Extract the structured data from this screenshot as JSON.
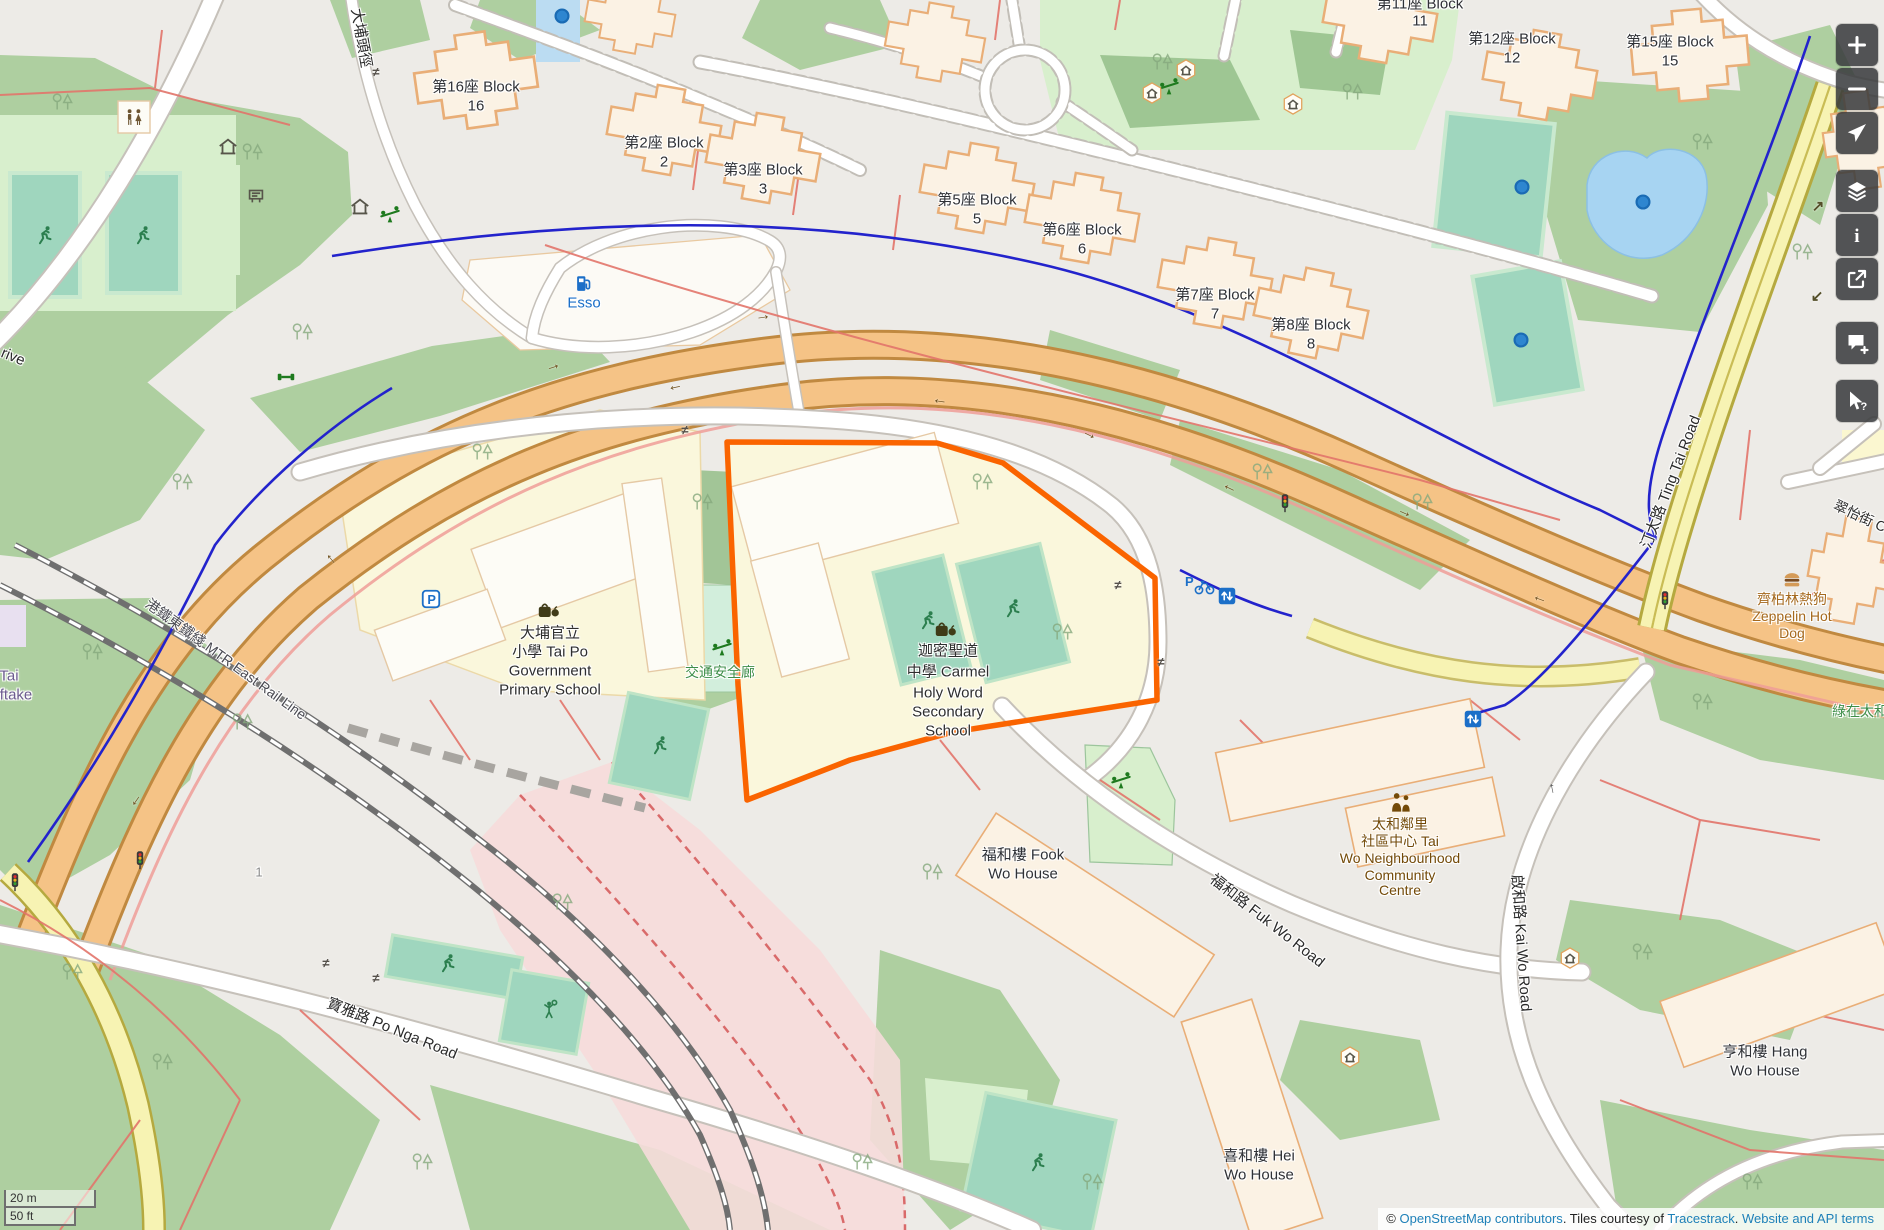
{
  "colors": {
    "highlight": "#FA6400",
    "link_blue": "#1E80B8",
    "trunk_road": "#F5C386",
    "secondary_road": "#F7F3B3",
    "water": "#A7D4F2",
    "pitch": "#9FD6BE",
    "wood": "#AECFA0",
    "building": "#FBF2E4",
    "control_bg": "rgba(56,58,60,0.86)"
  },
  "scalebar": {
    "metric": "20 m",
    "imperial": "50 ft"
  },
  "attribution": {
    "prefix": "© ",
    "link_osm": "OpenStreetMap contributors",
    "mid": ". Tiles courtesy of ",
    "link_tiles": "Tracestrack",
    "sep": ". ",
    "link_terms": "Website and API terms"
  },
  "controls": [
    {
      "name": "zoom-in-button",
      "icon": "plus",
      "y": 24
    },
    {
      "name": "zoom-out-button",
      "icon": "minus",
      "y": 68
    },
    {
      "name": "show-location-button",
      "icon": "locate",
      "y": 112
    },
    {
      "name": "layers-button",
      "icon": "layers",
      "y": 170
    },
    {
      "name": "map-key-button",
      "icon": "info",
      "y": 214
    },
    {
      "name": "share-button",
      "icon": "share",
      "y": 258
    },
    {
      "name": "add-note-button",
      "icon": "note",
      "y": 322
    },
    {
      "name": "query-features-button",
      "icon": "query",
      "y": 380
    }
  ],
  "map": {
    "highlighted_feature": "迦密聖道中學 Carmel Holy Word Secondary School",
    "labels": [
      {
        "name": "label-block-16-l1",
        "text": "第16座 Block",
        "x": 476,
        "y": 87,
        "color": "#2F3136",
        "size": 15
      },
      {
        "name": "label-block-16-l2",
        "text": "16",
        "x": 476,
        "y": 106,
        "color": "#2F3136",
        "size": 15
      },
      {
        "name": "label-block-2-l1",
        "text": "第2座 Block",
        "x": 664,
        "y": 143,
        "color": "#2F3136",
        "size": 15
      },
      {
        "name": "label-block-2-l2",
        "text": "2",
        "x": 664,
        "y": 162,
        "color": "#2F3136",
        "size": 15
      },
      {
        "name": "label-block-3-l1",
        "text": "第3座 Block",
        "x": 763,
        "y": 170,
        "color": "#2F3136",
        "size": 15
      },
      {
        "name": "label-block-3-l2",
        "text": "3",
        "x": 763,
        "y": 189,
        "color": "#2F3136",
        "size": 15
      },
      {
        "name": "label-block-5-l1",
        "text": "第5座 Block",
        "x": 977,
        "y": 200,
        "color": "#2F3136",
        "size": 15
      },
      {
        "name": "label-block-5-l2",
        "text": "5",
        "x": 977,
        "y": 219,
        "color": "#2F3136",
        "size": 15
      },
      {
        "name": "label-block-6-l1",
        "text": "第6座 Block",
        "x": 1082,
        "y": 230,
        "color": "#2F3136",
        "size": 15
      },
      {
        "name": "label-block-6-l2",
        "text": "6",
        "x": 1082,
        "y": 249,
        "color": "#2F3136",
        "size": 15
      },
      {
        "name": "label-block-7-l1",
        "text": "第7座 Block",
        "x": 1215,
        "y": 295,
        "color": "#2F3136",
        "size": 15
      },
      {
        "name": "label-block-7-l2",
        "text": "7",
        "x": 1215,
        "y": 314,
        "color": "#2F3136",
        "size": 15
      },
      {
        "name": "label-block-8-l1",
        "text": "第8座 Block",
        "x": 1311,
        "y": 325,
        "color": "#2F3136",
        "size": 15
      },
      {
        "name": "label-block-8-l2",
        "text": "8",
        "x": 1311,
        "y": 344,
        "color": "#2F3136",
        "size": 15
      },
      {
        "name": "label-block-11-l1",
        "text": "第11座 Block",
        "x": 1420,
        "y": 4,
        "color": "#2F3136",
        "size": 15
      },
      {
        "name": "label-block-11-l2",
        "text": "11",
        "x": 1420,
        "y": 21,
        "color": "#2F3136",
        "size": 15
      },
      {
        "name": "label-block-12-l1",
        "text": "第12座 Block",
        "x": 1512,
        "y": 39,
        "color": "#2F3136",
        "size": 15
      },
      {
        "name": "label-block-12-l2",
        "text": "12",
        "x": 1512,
        "y": 58,
        "color": "#2F3136",
        "size": 15
      },
      {
        "name": "label-block-15-l1",
        "text": "第15座 Block",
        "x": 1670,
        "y": 42,
        "color": "#2F3136",
        "size": 15
      },
      {
        "name": "label-block-15-l2",
        "text": "15",
        "x": 1670,
        "y": 61,
        "color": "#2F3136",
        "size": 15
      },
      {
        "name": "label-primary-school-l1",
        "text": "大埔官立",
        "x": 550,
        "y": 633,
        "color": "#2E2E2E",
        "size": 15
      },
      {
        "name": "label-primary-school-l2",
        "text": "小學 Tai Po",
        "x": 550,
        "y": 652,
        "color": "#2E2E2E",
        "size": 15
      },
      {
        "name": "label-primary-school-l3",
        "text": "Government",
        "x": 550,
        "y": 671,
        "color": "#2E2E2E",
        "size": 15
      },
      {
        "name": "label-primary-school-l4",
        "text": "Primary School",
        "x": 550,
        "y": 690,
        "color": "#2E2E2E",
        "size": 15
      },
      {
        "name": "label-carmel-school-l1",
        "text": "迦密聖道",
        "x": 948,
        "y": 651,
        "color": "#2E2E2E",
        "size": 15
      },
      {
        "name": "label-carmel-school-l2",
        "text": "中學 Carmel",
        "x": 948,
        "y": 672,
        "color": "#2E2E2E",
        "size": 15
      },
      {
        "name": "label-carmel-school-l3",
        "text": "Holy Word",
        "x": 948,
        "y": 693,
        "color": "#2E2E2E",
        "size": 15
      },
      {
        "name": "label-carmel-school-l4",
        "text": "Secondary",
        "x": 948,
        "y": 712,
        "color": "#2E2E2E",
        "size": 15
      },
      {
        "name": "label-carmel-school-l5",
        "text": "School",
        "x": 948,
        "y": 731,
        "color": "#2E2E2E",
        "size": 15
      },
      {
        "name": "label-traffic-safety-gallery",
        "text": "交通安全廊",
        "x": 720,
        "y": 672,
        "color": "#3E8E49",
        "size": 14
      },
      {
        "name": "label-esso",
        "text": "Esso",
        "x": 584,
        "y": 303,
        "color": "#1C6FC8",
        "size": 15
      },
      {
        "name": "label-fook-wo-house-l1",
        "text": "福和樓 Fook",
        "x": 1023,
        "y": 855,
        "color": "#2F3136",
        "size": 15
      },
      {
        "name": "label-fook-wo-house-l2",
        "text": "Wo House",
        "x": 1023,
        "y": 874,
        "color": "#2F3136",
        "size": 15
      },
      {
        "name": "label-hei-wo-house-l1",
        "text": "喜和樓 Hei",
        "x": 1259,
        "y": 1156,
        "color": "#2F3136",
        "size": 15
      },
      {
        "name": "label-hei-wo-house-l2",
        "text": "Wo House",
        "x": 1259,
        "y": 1175,
        "color": "#2F3136",
        "size": 15
      },
      {
        "name": "label-hang-wo-house-l1",
        "text": "亨和樓 Hang",
        "x": 1765,
        "y": 1052,
        "color": "#2F3136",
        "size": 15
      },
      {
        "name": "label-hang-wo-house-l2",
        "text": "Wo House",
        "x": 1765,
        "y": 1071,
        "color": "#2F3136",
        "size": 15
      },
      {
        "name": "label-community-centre-l1",
        "text": "太和鄰里",
        "x": 1400,
        "y": 824,
        "color": "#734A08",
        "size": 14
      },
      {
        "name": "label-community-centre-l2",
        "text": "社區中心 Tai",
        "x": 1400,
        "y": 841,
        "color": "#734A08",
        "size": 14
      },
      {
        "name": "label-community-centre-l3",
        "text": "Wo Neighbourhood",
        "x": 1400,
        "y": 858,
        "color": "#734A08",
        "size": 14
      },
      {
        "name": "label-community-centre-l4",
        "text": "Community",
        "x": 1400,
        "y": 875,
        "color": "#734A08",
        "size": 14
      },
      {
        "name": "label-community-centre-l5",
        "text": "Centre",
        "x": 1400,
        "y": 890,
        "color": "#734A08",
        "size": 14
      },
      {
        "name": "label-zeppelin-l1",
        "text": "齊柏林熱狗",
        "x": 1792,
        "y": 599,
        "color": "#A5691E",
        "size": 14
      },
      {
        "name": "label-zeppelin-l2",
        "text": "Zeppelin Hot",
        "x": 1792,
        "y": 616,
        "color": "#A5691E",
        "size": 14
      },
      {
        "name": "label-zeppelin-l3",
        "text": "Dog",
        "x": 1792,
        "y": 633,
        "color": "#A5691E",
        "size": 14
      },
      {
        "name": "label-green-tai-wo",
        "text": "綠在太和",
        "x": 1860,
        "y": 711,
        "color": "#3E8E49",
        "size": 14
      },
      {
        "name": "label-ting-tai-road",
        "text": "汀太路 Ting Tai Road",
        "x": 1671,
        "y": 482,
        "color": "#2A2A2A",
        "size": 15,
        "rot": -69
      },
      {
        "name": "label-po-nga-road",
        "text": "寶雅路 Po Nga Road",
        "x": 392,
        "y": 1029,
        "color": "#2A2A2A",
        "size": 15,
        "rot": 22
      },
      {
        "name": "label-fuk-wo-road",
        "text": "福和路 Fuk Wo Road",
        "x": 1267,
        "y": 921,
        "color": "#2A2A2A",
        "size": 15,
        "rot": 38
      },
      {
        "name": "label-kai-wo-road",
        "text": "啟和路 Kai Wo Road",
        "x": 1521,
        "y": 943,
        "color": "#2A2A2A",
        "size": 15,
        "rot": 86
      },
      {
        "name": "label-tai-po-tau-path",
        "text": "大埔頭徑",
        "x": 361,
        "y": 38,
        "color": "#2A2A2A",
        "size": 15,
        "rot": 80
      },
      {
        "name": "label-mtr-east-rail",
        "text": "港鐵東鐵綫 MTR East Rail Line",
        "x": 226,
        "y": 659,
        "color": "#4A4A52",
        "size": 14,
        "rot": 36
      },
      {
        "name": "label-tsui-yi-street",
        "text": "翠怡街 C",
        "x": 1860,
        "y": 516,
        "color": "#2A2A2A",
        "size": 14,
        "rot": 25
      },
      {
        "name": "label-drive-partial",
        "text": "rive",
        "x": 13,
        "y": 357,
        "color": "#2A2A2A",
        "size": 15,
        "rot": 22
      },
      {
        "name": "label-tai-partial",
        "text": "Tai",
        "x": 9,
        "y": 676,
        "color": "#6B5B8E",
        "size": 15
      },
      {
        "name": "label-ftake-partial",
        "text": "ftake",
        "x": 16,
        "y": 695,
        "color": "#6B5B8E",
        "size": 15
      },
      {
        "name": "label-building-1",
        "text": "1",
        "x": 259,
        "y": 873,
        "color": "#8A8A8A",
        "size": 13
      }
    ],
    "pois": [
      {
        "name": "school-icon",
        "type": "school",
        "x": 548,
        "y": 610
      },
      {
        "name": "school-icon",
        "type": "school",
        "x": 945,
        "y": 629
      },
      {
        "name": "running-icon",
        "type": "runner",
        "x": 45,
        "y": 235
      },
      {
        "name": "running-icon",
        "type": "runner",
        "x": 143,
        "y": 235
      },
      {
        "name": "running-icon",
        "type": "runner",
        "x": 928,
        "y": 620
      },
      {
        "name": "running-icon",
        "type": "runner",
        "x": 1013,
        "y": 608
      },
      {
        "name": "running-icon",
        "type": "runner",
        "x": 660,
        "y": 745
      },
      {
        "name": "running-icon",
        "type": "runner",
        "x": 448,
        "y": 963
      },
      {
        "name": "running-icon",
        "type": "runner",
        "x": 1038,
        "y": 1162
      },
      {
        "name": "tennis-icon",
        "type": "tennis",
        "x": 550,
        "y": 1010
      },
      {
        "name": "playground-icon",
        "type": "seesaw",
        "x": 390,
        "y": 215
      },
      {
        "name": "playground-icon",
        "type": "seesaw",
        "x": 722,
        "y": 648
      },
      {
        "name": "playground-icon",
        "type": "seesaw",
        "x": 1169,
        "y": 87
      },
      {
        "name": "playground-icon",
        "type": "seesaw",
        "x": 1121,
        "y": 781
      },
      {
        "name": "shelter-icon",
        "type": "shelter",
        "x": 228,
        "y": 147
      },
      {
        "name": "shelter-icon",
        "type": "shelter",
        "x": 360,
        "y": 207
      },
      {
        "name": "shelter-icon",
        "type": "shelterhex",
        "x": 1152,
        "y": 93
      },
      {
        "name": "shelter-icon",
        "type": "shelterhex",
        "x": 1186,
        "y": 70
      },
      {
        "name": "shelter-icon",
        "type": "shelterhex",
        "x": 1293,
        "y": 104
      },
      {
        "name": "shelter-icon",
        "type": "shelterhex",
        "x": 1570,
        "y": 958
      },
      {
        "name": "shelter-icon",
        "type": "shelterhex",
        "x": 1350,
        "y": 1057
      },
      {
        "name": "toilets-icon",
        "type": "toilets",
        "x": 134,
        "y": 118
      },
      {
        "name": "notice-board-icon",
        "type": "board",
        "x": 256,
        "y": 196
      },
      {
        "name": "fitness-icon",
        "type": "fitness",
        "x": 286,
        "y": 377
      },
      {
        "name": "fuel-icon",
        "type": "fuel",
        "x": 584,
        "y": 284
      },
      {
        "name": "fast-food-icon",
        "type": "burger",
        "x": 1792,
        "y": 580
      },
      {
        "name": "community-centre-icon",
        "type": "community",
        "x": 1401,
        "y": 803
      },
      {
        "name": "parking-icon",
        "type": "parking",
        "x": 431,
        "y": 599
      },
      {
        "name": "bicycle-parking-icon",
        "type": "bikepark",
        "x": 1200,
        "y": 585
      },
      {
        "name": "elevator-icon",
        "type": "elevator",
        "x": 1473,
        "y": 719
      },
      {
        "name": "elevator-icon",
        "type": "elevator",
        "x": 1227,
        "y": 596
      },
      {
        "name": "traffic-signal-icon",
        "type": "traffic",
        "x": 140,
        "y": 860
      },
      {
        "name": "traffic-signal-icon",
        "type": "traffic",
        "x": 15,
        "y": 882
      },
      {
        "name": "traffic-signal-icon",
        "type": "traffic",
        "x": 1665,
        "y": 600
      },
      {
        "name": "traffic-signal-icon",
        "type": "traffic",
        "x": 1285,
        "y": 503
      },
      {
        "name": "fountain-icon",
        "type": "fountain",
        "x": 562,
        "y": 16
      },
      {
        "name": "fountain-icon",
        "type": "fountain",
        "x": 1522,
        "y": 187
      },
      {
        "name": "fountain-icon",
        "type": "fountain",
        "x": 1643,
        "y": 202
      },
      {
        "name": "fountain-icon",
        "type": "fountain",
        "x": 1521,
        "y": 340
      },
      {
        "name": "crossing-icon",
        "glyph": "≠",
        "x": 376,
        "y": 72,
        "color": "#55504a",
        "size": 13
      },
      {
        "name": "crossing-icon",
        "glyph": "≠",
        "x": 685,
        "y": 430,
        "color": "#55504a",
        "size": 13
      },
      {
        "name": "crossing-icon",
        "glyph": "≠",
        "x": 1118,
        "y": 585,
        "color": "#55504a",
        "size": 13
      },
      {
        "name": "crossing-icon",
        "glyph": "≠",
        "x": 1161,
        "y": 662,
        "color": "#55504a",
        "size": 13
      },
      {
        "name": "crossing-icon",
        "glyph": "≠",
        "x": 326,
        "y": 963,
        "color": "#55504a",
        "size": 13
      },
      {
        "name": "crossing-icon",
        "glyph": "≠",
        "x": 376,
        "y": 978,
        "color": "#55504a",
        "size": 13
      },
      {
        "name": "oneway-arrow-icon",
        "glyph": "→",
        "x": 553,
        "y": 366,
        "color": "#6E501E",
        "size": 16,
        "rot": -18
      },
      {
        "name": "oneway-arrow-icon",
        "glyph": "→",
        "x": 763,
        "y": 316,
        "color": "#6E501E",
        "size": 16,
        "rot": -8
      },
      {
        "name": "oneway-arrow-icon",
        "glyph": "→",
        "x": 1090,
        "y": 434,
        "color": "#6E501E",
        "size": 16,
        "rot": 26
      },
      {
        "name": "oneway-arrow-icon",
        "glyph": "→",
        "x": 1405,
        "y": 512,
        "color": "#6E501E",
        "size": 16,
        "rot": 24
      },
      {
        "name": "oneway-arrow-icon",
        "glyph": "→",
        "x": 330,
        "y": 560,
        "color": "#6E501E",
        "size": 16,
        "rot": -130
      },
      {
        "name": "oneway-arrow-icon",
        "glyph": "←",
        "x": 675,
        "y": 386,
        "color": "#6E501E",
        "size": 16,
        "rot": -12
      },
      {
        "name": "oneway-arrow-icon",
        "glyph": "←",
        "x": 940,
        "y": 400,
        "color": "#6E501E",
        "size": 16,
        "rot": 8
      },
      {
        "name": "oneway-arrow-icon",
        "glyph": "←",
        "x": 1230,
        "y": 487,
        "color": "#6E501E",
        "size": 16,
        "rot": 26
      },
      {
        "name": "oneway-arrow-icon",
        "glyph": "←",
        "x": 1540,
        "y": 598,
        "color": "#6E501E",
        "size": 16,
        "rot": 20
      },
      {
        "name": "oneway-arrow-icon",
        "glyph": "←",
        "x": 135,
        "y": 800,
        "color": "#6E501E",
        "size": 16,
        "rot": -55
      },
      {
        "name": "oneway-arrow-icon",
        "glyph": "↗",
        "x": 1818,
        "y": 206,
        "color": "#55502a",
        "size": 15
      },
      {
        "name": "oneway-arrow-icon",
        "glyph": "↙",
        "x": 1817,
        "y": 296,
        "color": "#55502a",
        "size": 15
      },
      {
        "name": "oneway-arrow-icon",
        "glyph": "↑",
        "x": 1552,
        "y": 788,
        "color": "#555",
        "size": 15,
        "rot": -12
      }
    ]
  }
}
